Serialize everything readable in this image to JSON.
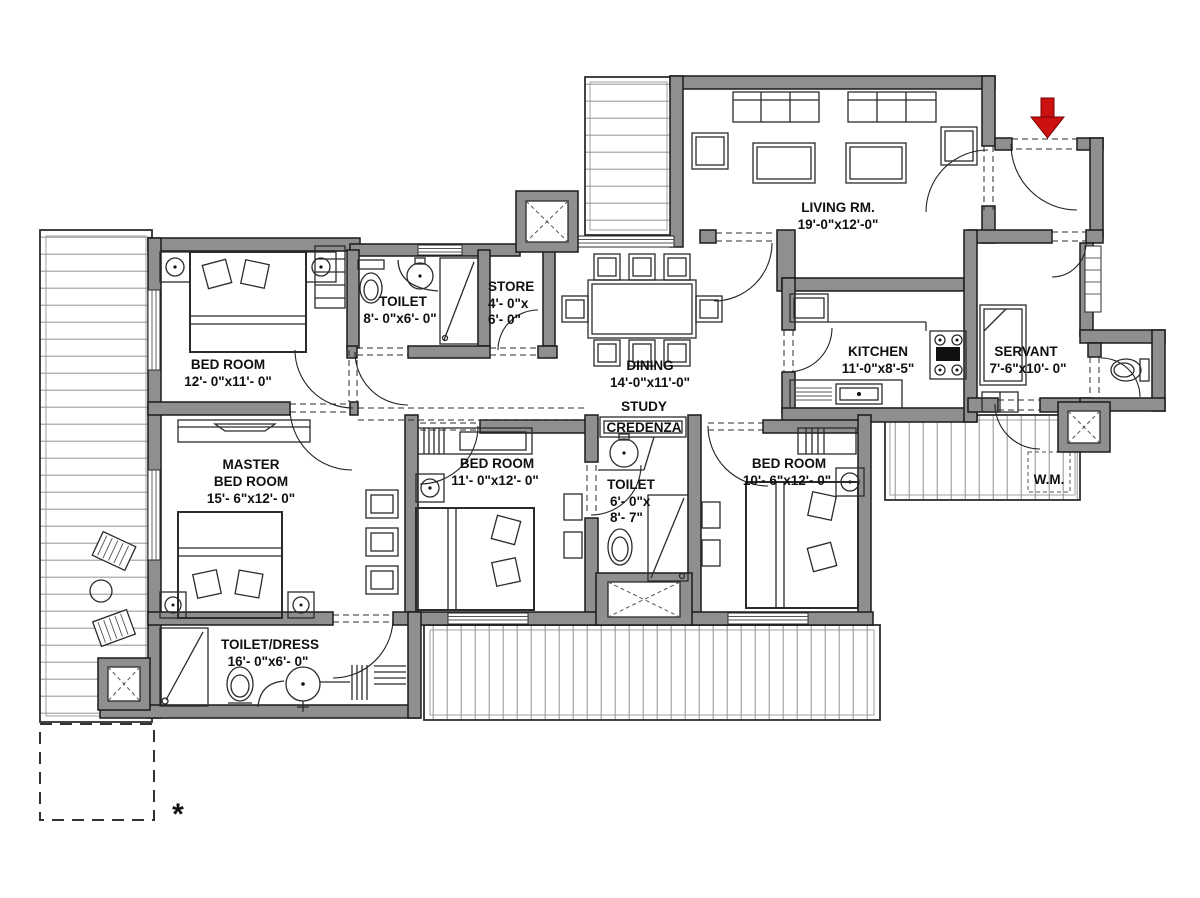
{
  "meta": {
    "type": "architectural-floor-plan"
  },
  "colors": {
    "bg": "#ffffff",
    "wall": "#8f8f8f",
    "line": "#1a1a1a",
    "plank": "#9c9c9c",
    "arrow": "#cc1111"
  },
  "rooms": {
    "living": {
      "name": "LIVING RM.",
      "dims": "19'-0\"x12'-0\""
    },
    "bed1": {
      "name": "BED ROOM",
      "dims": "12'- 0\"x11'- 0\""
    },
    "toilet1": {
      "name": "TOILET",
      "dims": "8'- 0\"x6'- 0\""
    },
    "store": {
      "name": "STORE",
      "dims1": "4'- 0\"x",
      "dims2": "6'- 0\""
    },
    "dining": {
      "name": "DINING",
      "dims": "14'-0\"x11'-0\""
    },
    "study": {
      "line1": "STUDY",
      "line2": "CREDENZA"
    },
    "kitchen": {
      "name": "KITCHEN",
      "dims": "11'-0\"x8'-5\""
    },
    "servant": {
      "name": "SERVANT",
      "dims": "7'-6\"x10'- 0\""
    },
    "master": {
      "line1": "MASTER",
      "line2": "BED ROOM",
      "dims": "15'- 6\"x12'- 0\""
    },
    "bed2": {
      "name": "BED ROOM",
      "dims": "11'- 0\"x12'- 0\""
    },
    "toilet2": {
      "name": "TOILET",
      "dims1": "6'- 0\"x",
      "dims2": "8'- 7\""
    },
    "bed3": {
      "name": "BED ROOM",
      "dims": "10'- 6\"x12'- 0\""
    },
    "toilet_dress": {
      "name": "TOILET/DRESS",
      "dims": "16'- 0\"x6'- 0\""
    },
    "wm": {
      "name": "W.M."
    },
    "footnote": {
      "symbol": "*"
    }
  }
}
